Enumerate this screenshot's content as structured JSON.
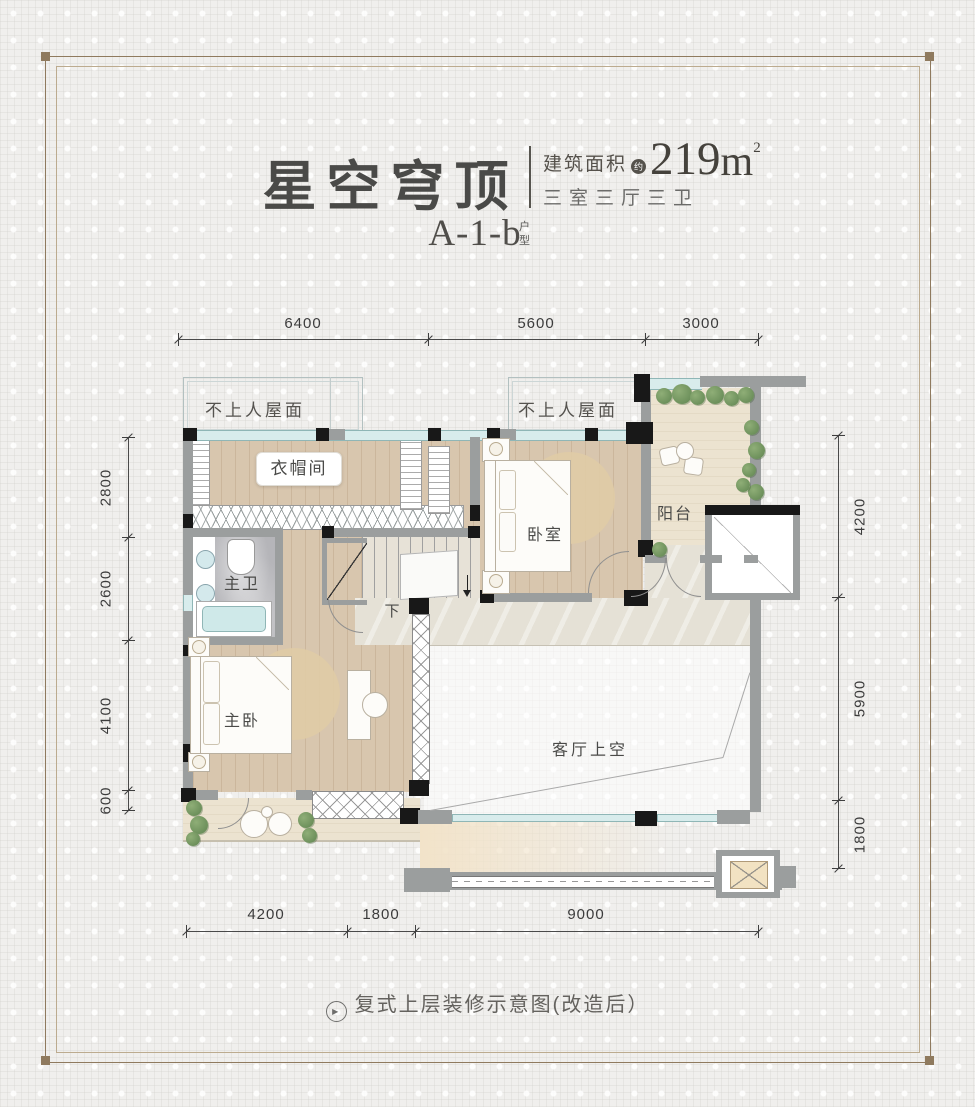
{
  "header": {
    "title": "星空穹顶",
    "area_label": "建筑面积",
    "area_note": "约",
    "area_value": "219",
    "area_unit": "m",
    "area_sup": "2",
    "spec": "三室三厅三卫",
    "unit_code": "A-1-b",
    "unit_suffix_top": "户",
    "unit_suffix_bottom": "型"
  },
  "dimensions": {
    "top": [
      "6400",
      "5600",
      "3000"
    ],
    "left": [
      "2800",
      "2600",
      "4100",
      "600"
    ],
    "right": [
      "4200",
      "5900",
      "1800"
    ],
    "bottom": [
      "4200",
      "1800",
      "9000"
    ]
  },
  "rooms": {
    "roof_left": "不上人屋面",
    "roof_right": "不上人屋面",
    "cloakroom": "衣帽间",
    "master_bath": "主卫",
    "bedroom": "卧室",
    "balcony": "阳台",
    "master_bedroom": "主卧",
    "living_void": "客厅上空",
    "stair_down": "下"
  },
  "caption": {
    "icon": "▶",
    "text": "复式上层装修示意图(改造后）"
  },
  "colors": {
    "page_bg": "#f0efed",
    "frame": "#8f7a5e",
    "title_text": "#4a4a48",
    "wall": "#9b9e9e",
    "column": "#181818",
    "window": "#d8ecec",
    "wood_floor": "#d8c6ae",
    "stone_floor": "#e5e1d6",
    "balcony_floor": "#ece3d0",
    "plant": "#6f9760",
    "bathtub": "#cfe9e9"
  }
}
